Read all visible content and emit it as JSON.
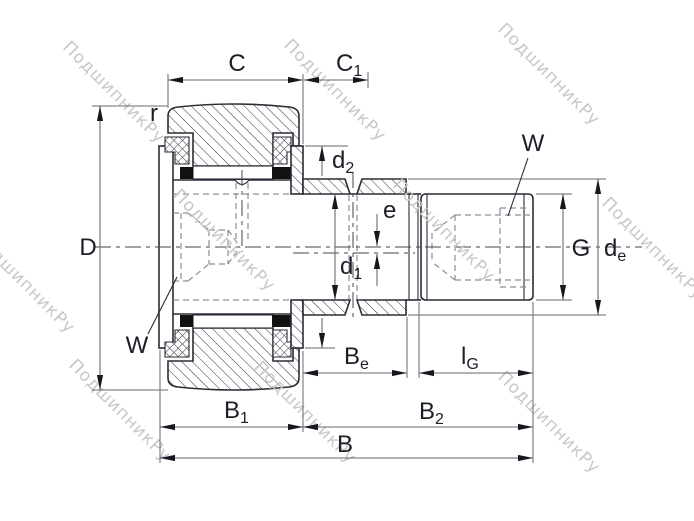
{
  "drawing": {
    "watermark": {
      "text": "ПодшипникРу"
    },
    "labels": {
      "outer_ring_width": {
        "main": "C",
        "sub": ""
      },
      "collar_protrusion": {
        "main": "C",
        "sub": "1"
      },
      "corner_radius": {
        "main": "r",
        "sub": ""
      },
      "outer_diameter": {
        "main": "D",
        "sub": ""
      },
      "hex_socket_top": {
        "main": "W",
        "sub": ""
      },
      "collar_diameter": {
        "main": "d",
        "sub": "2"
      },
      "eccentricity": {
        "main": "e",
        "sub": ""
      },
      "stud_diameter": {
        "main": "d",
        "sub": "1"
      },
      "hex_socket_bottom": {
        "main": "W",
        "sub": ""
      },
      "thread": {
        "main": "G",
        "sub": ""
      },
      "thread_end_diameter": {
        "main": "d",
        "sub": "e"
      },
      "collar_width": {
        "main": "B",
        "sub": "e"
      },
      "thread_length": {
        "main": "l",
        "sub": "G"
      },
      "head_width": {
        "main": "B",
        "sub": "1"
      },
      "stud_side_width": {
        "main": "B",
        "sub": "2"
      },
      "total_width": {
        "main": "B",
        "sub": ""
      }
    },
    "colors": {
      "outline": "#2b2b36",
      "dimension_line": "#6a6a72",
      "hidden_line": "#8d8d96",
      "label_text": "#1d1d28",
      "watermark": "#c8c8c8",
      "seal_fill": "#111111",
      "background": "#ffffff"
    }
  }
}
